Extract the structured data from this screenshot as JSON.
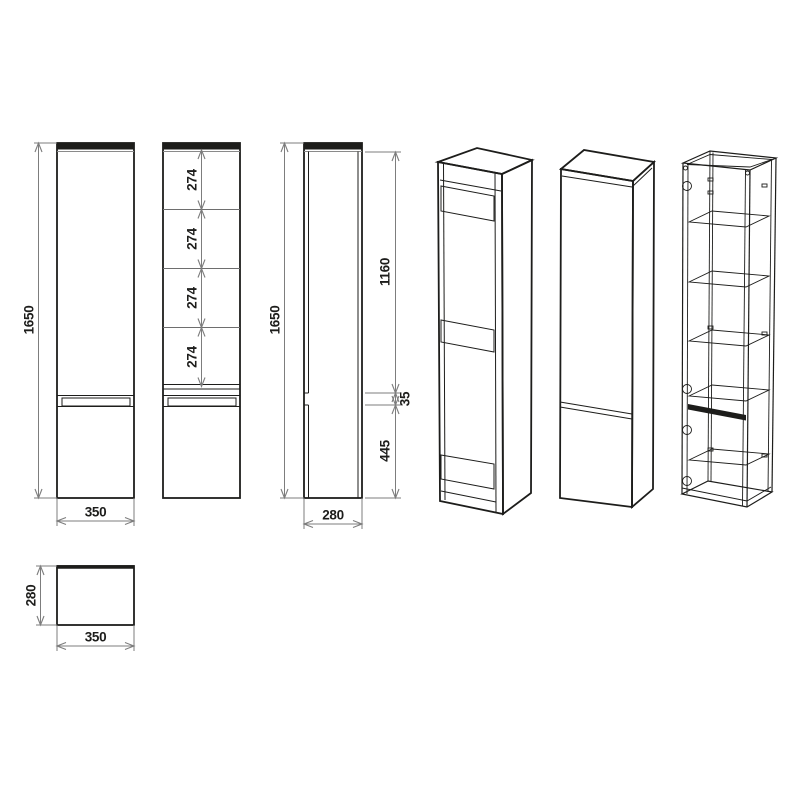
{
  "views": {
    "front": {
      "height": "1650",
      "width": "350"
    },
    "shelf_spacings": [
      "274",
      "274",
      "274",
      "274"
    ],
    "side": {
      "height": "1650",
      "upper_door": "1160",
      "gap": "35",
      "lower_door": "445",
      "depth": "280"
    },
    "top": {
      "depth": "280",
      "width": "350"
    }
  },
  "colors": {
    "object_line": "#1d1d1b",
    "dimension_line": "#7d7d7d",
    "background": "#ffffff"
  }
}
